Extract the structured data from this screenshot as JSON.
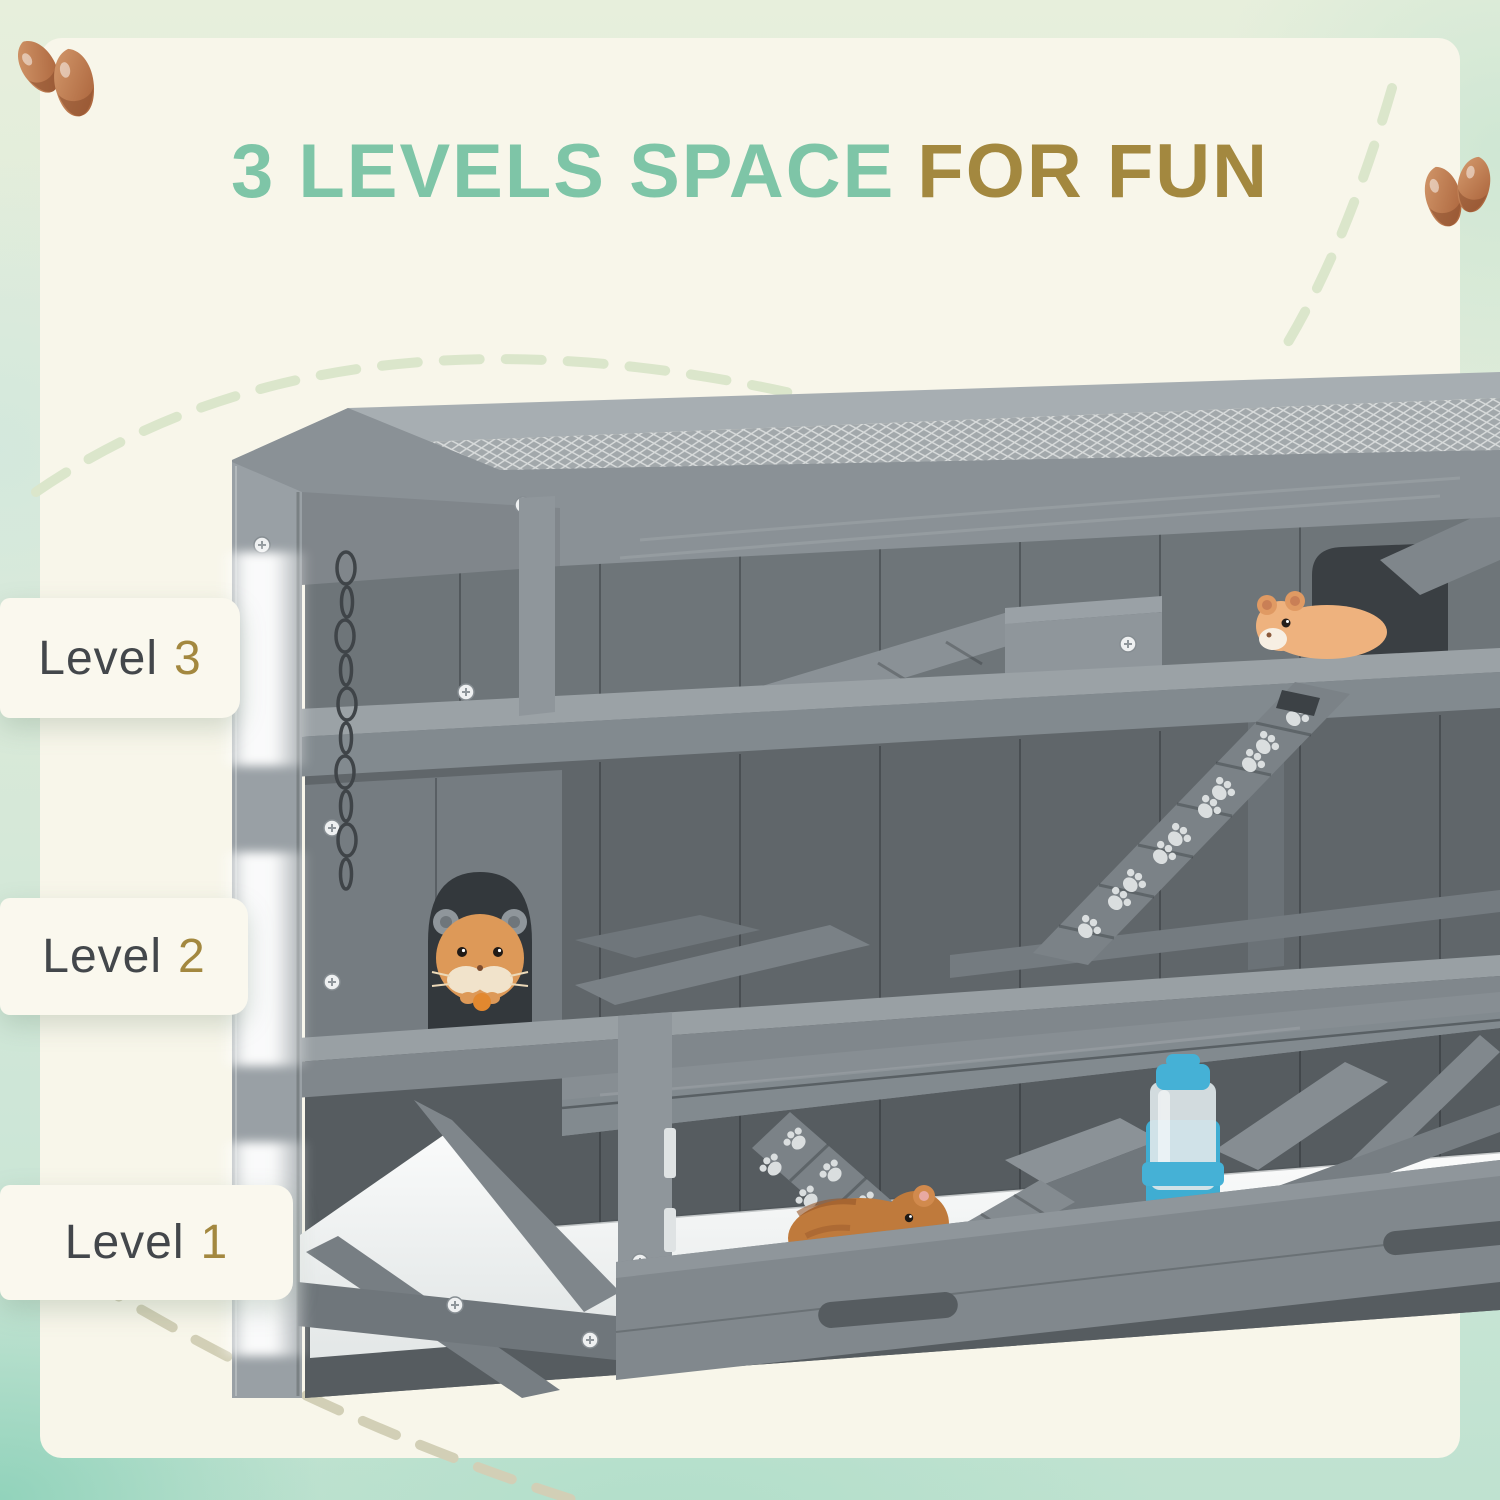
{
  "page": {
    "kind": "product-feature-graphic"
  },
  "title": {
    "highlight": "3 LEVELS SPACE",
    "rest": "FOR FUN"
  },
  "level_callouts": [
    {
      "label": "Level",
      "number": "3"
    },
    {
      "label": "Level",
      "number": "2"
    },
    {
      "label": "Level",
      "number": "1"
    }
  ],
  "scene": {
    "subject": "3-tier gray wooden hamster cage with wire mesh top",
    "icons": [
      "almond-icon",
      "hamster-icon",
      "paw-prints-icon",
      "water-bottle-icon",
      "mesh-top",
      "ladder-ramp",
      "hide-house-hole",
      "hanging-chain",
      "dashed-arc"
    ]
  },
  "colors": {
    "accent_teal": "#7ec5a7",
    "accent_gold": "#a3883f",
    "panel_cream": "#f8f6ea",
    "border_mint": "#cde6d8",
    "label_bg": "#faf8ee",
    "label_text": "#43474b",
    "wood_gray": "#8a9196",
    "interior_gray": "#60666a",
    "floor_white": "#f2f4f4",
    "bottle_blue": "#45b1d6",
    "hamster_orange": "#e9a96e",
    "dash_green": "#dbe6cb",
    "dash_beige": "#d2cfb6"
  }
}
